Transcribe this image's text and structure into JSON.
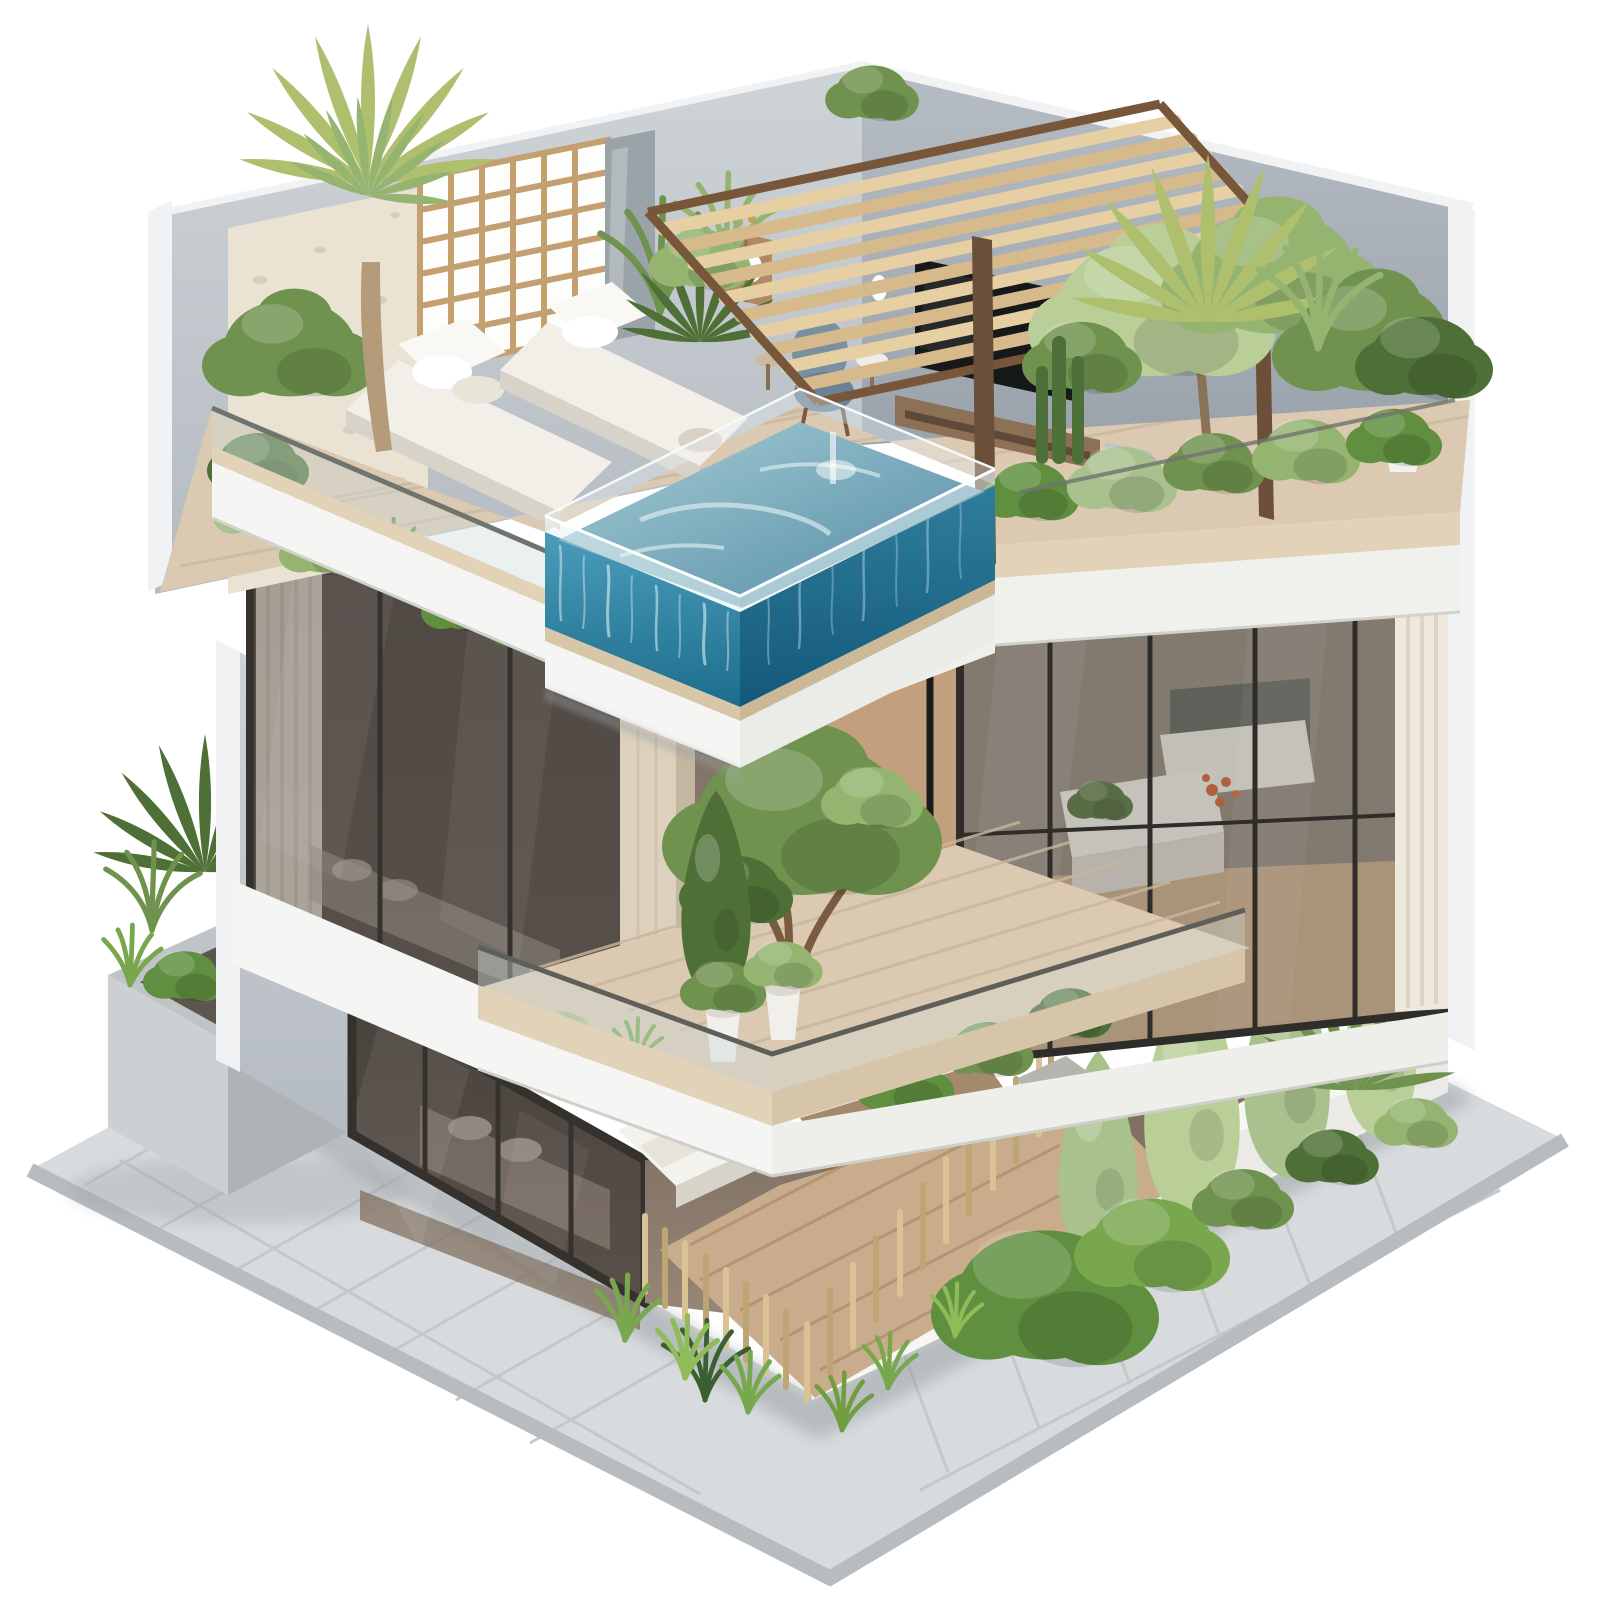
{
  "image": {
    "kind": "3d-architectural-render",
    "subject": "isometric cutaway of a modern three-story villa with rooftop pool and terraced gardens",
    "background": "#ffffff"
  },
  "colors": {
    "background": "#ffffff",
    "pavement": "#d8dbdd",
    "pavementEdge": "#b6bcc0",
    "pavementLine": "#c3c8cb",
    "buildingShadow": "#8f979c",
    "planterLight": "#cdd0d2",
    "planterDark": "#aeb3b7",
    "wallTrim": "#f1f2f3",
    "wallLeftTop": "#ced3d7",
    "wallLeftBottom": "#b4bbc1",
    "wallRightTop": "#b6bdc4",
    "wallRightBottom": "#9aa2ab",
    "travertine": "#eae3d4",
    "latticeWood": "#c49f6f",
    "grayPanel": "#99a3a8",
    "pergolaSlat": "#e6cfa3",
    "pergolaSlatDark": "#d6ba8b",
    "pergolaFrame": "#775639",
    "palmTrunk": "#b59b79",
    "palmGreen": "#aebf6e",
    "deckWood": "#dbc9b2",
    "deckLine": "#c9b69d",
    "fascia": "#f5f5f3",
    "fasciaTan": "#e2d2b8",
    "glassTint": "#cfdddc",
    "glassRail": "#70746f",
    "poolTopLight": "#a9cdd6",
    "poolTopDark": "#4f8ba3",
    "poolLeftTop": "#4a9db9",
    "poolLeftBottom": "#1d6d8e",
    "poolRightTop": "#2f7e9c",
    "poolRightBottom": "#14587a",
    "waterStreak": "#dff0f4",
    "daybed": "#f2efe9",
    "daybedShade": "#d8d3c9",
    "tvDark": "#17181a",
    "consoleWood": "#8d7156",
    "chairBlue": "#7a90a2",
    "sconceWhite": "#fdfdfd",
    "windowFrame": "#35322e",
    "windowGlassTop": "#564f49",
    "windowGlassBottom": "#6b635c",
    "doorGlassTop": "#524a44",
    "doorGlassBottom": "#6e635a",
    "curtain": "#efe9dd",
    "curtainLine": "#dcd4c4",
    "interiorTop": "#79695c",
    "interiorBottom": "#98887a",
    "woodFloor": "#c7a987",
    "woodPanel": "#c2a07e",
    "columnStone": "#ddd1bd",
    "bathWhite": "#f0efe9",
    "mirror": "#595d57",
    "flowerOrange": "#cf5f2e",
    "fenceWood": "#d9c293",
    "fenceWoodDark": "#bda674",
    "groundDeck": "#c9ac8c",
    "groundDeckLine": "#b08f6f",
    "bedWhite": "#f4f2ec",
    "rattan": "#9a7d60",
    "rockGray": "#b5b4ae",
    "greenDark": "#4e7036",
    "greenMid": "#6f924e",
    "greenLight": "#94b470",
    "greenPale": "#b9cf97",
    "vineGreen": "#a9c18d",
    "grassGreen": "#79a74e",
    "hedgeGreen": "#5f8f3f"
  },
  "scene": {
    "rooftop_terrace": [
      "wood slat pergola",
      "glass-walled plunge pool",
      "two white daybeds",
      "timber lattice screen",
      "palm tree",
      "tv lounge corner",
      "blue armchair",
      "planted glass balustrade"
    ],
    "middle_floor": [
      "bedroom behind tinted glass with curtain",
      "balcony garden with tree, potted plants and rock",
      "stone column",
      "bathroom behind glass with white vanity and curtain",
      "glass balustrade"
    ],
    "ground_floor": [
      "tinted glass sliding doors",
      "bedroom bed at the cutaway",
      "wooden deck with timber furniture",
      "timber picket fence",
      "garden with hedges and climbing trees",
      "white boundary wall"
    ],
    "surroundings": [
      "stone paved walkway",
      "concrete planter with palm and ferns",
      "soft ground shadow"
    ]
  }
}
